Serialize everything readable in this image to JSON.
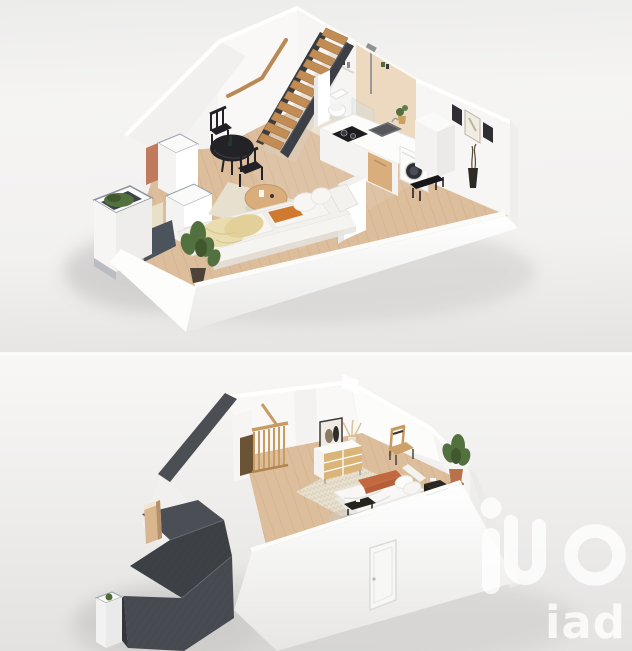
{
  "image": {
    "kind": "two stacked 3D cutaway floor-plan renders",
    "panel_1": "ground floor: living room, dining corner, kitchen, shower room, staircase",
    "panel_2": "upper floor: bedroom under charcoal sloped roof"
  },
  "watermark": {
    "brand_text": "iad",
    "mark": "ino-loop-logo",
    "color": "#ffffff"
  },
  "palette": {
    "background_top": "#f3f2f1",
    "background_bottom": "#e7e6e5",
    "wall_white": "#f9f8f7",
    "wall_shade": "#efeeed",
    "floor_wood": "#dcbd9c",
    "bath_floor": "#eae3d2",
    "shower_tile": "#ecd9bf",
    "charcoal": "#474a50",
    "charcoal_dark": "#383b40",
    "stair_tread_wood": "#c28c55",
    "handrail_wood": "#b98a55",
    "sofa_white": "#f2f1ee",
    "cushion_cream": "#e9dcae",
    "accent_orange": "#cf7a2e",
    "black_furniture": "#232327",
    "coffee_table_wood": "#d9ae7c",
    "rug_beige": "#e8e1d1",
    "plant_green": "#53703f",
    "terracotta": "#c07b5e",
    "bed_throw_terracotta": "#c2693f",
    "dresser_oak": "#dbb478",
    "night_stand_dark": "#2b2825",
    "tan_chair": "#cda268",
    "appliance_dark": "#2e2e33",
    "shadow": "#c9c8c6"
  },
  "ground_floor": {
    "elements": [
      "sloped-attic-wall",
      "staircase-wood-treads",
      "wall-handrail",
      "shower-tile-wall",
      "shower-fixture",
      "glass-screen",
      "toilet",
      "kitchen-counter",
      "cooktop",
      "sink",
      "wood-cabinet",
      "washing-machine",
      "counter-plant",
      "wall-frames",
      "round-dining-table",
      "dining-chairs",
      "coffee-table",
      "area-rug",
      "sofa",
      "throw-pillows",
      "accent-pillow-orange",
      "floor-plant",
      "entry-bench",
      "floor-vase",
      "closets",
      "planter-box",
      "front-cutaway-wall"
    ]
  },
  "upper_floor": {
    "elements": [
      "bedroom-walls",
      "wood-floor",
      "patterned-rug",
      "double-bed",
      "terracotta-throw",
      "pillows",
      "nightstand",
      "foot-bench",
      "dresser",
      "leaning-art-frame",
      "pampas-vase",
      "accent-chair",
      "potted-plant",
      "stair-railing",
      "roof-dormers-charcoal",
      "chimney",
      "front-door",
      "planter-box"
    ]
  }
}
